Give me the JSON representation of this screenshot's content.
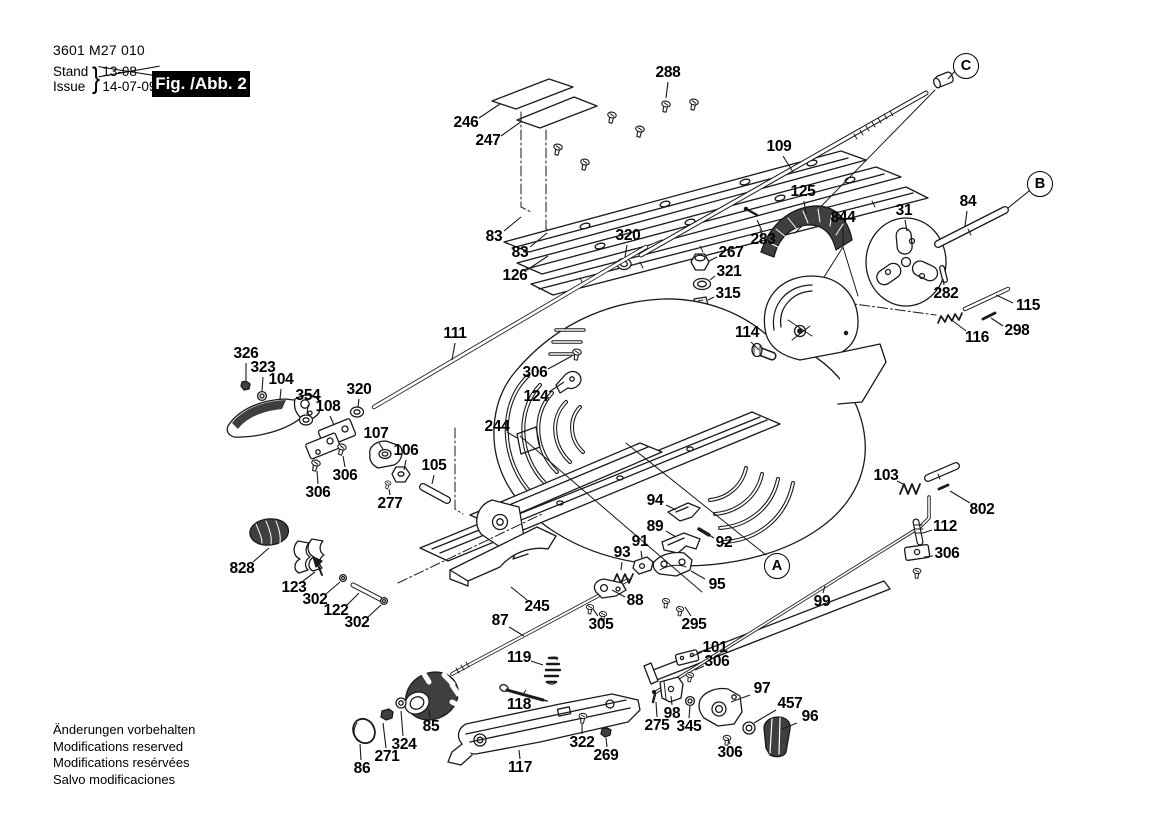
{
  "header": {
    "model_number": "3601 M27 010",
    "revision": {
      "stand_label": "Stand",
      "stand_value": "13-08",
      "issue_label": "Issue",
      "issue_value": "14-07-09",
      "brace": "}"
    },
    "figure_label": "Fig. /Abb. 2"
  },
  "footer": {
    "lines": [
      "Änderungen vorbehalten",
      "Modifications reserved",
      "Modifications resérvées",
      "Salvo modificaciones"
    ]
  },
  "colors": {
    "ink": "#1a1a1a",
    "paper": "#ffffff",
    "figure_box_bg": "#000000",
    "figure_box_text": "#ffffff",
    "dark_part": "#3f3f3f"
  },
  "diagram": {
    "reference_bubbles": [
      {
        "label": "A",
        "x": 777,
        "y": 566
      },
      {
        "label": "B",
        "x": 1040,
        "y": 184,
        "leader": [
          1029,
          191,
          1008,
          208
        ]
      },
      {
        "label": "C",
        "x": 966,
        "y": 66,
        "leader": [
          955,
          71,
          948,
          79
        ]
      }
    ],
    "callouts": [
      {
        "label": "288",
        "x": 668,
        "y": 73,
        "leader": [
          668,
          82,
          666,
          98
        ]
      },
      {
        "label": "246",
        "x": 466,
        "y": 123,
        "leader": [
          479,
          118,
          500,
          104
        ]
      },
      {
        "label": "247",
        "x": 488,
        "y": 141,
        "leader": [
          501,
          136,
          522,
          121
        ]
      },
      {
        "label": "83",
        "x": 494,
        "y": 237,
        "leader": [
          504,
          231,
          521,
          217
        ]
      },
      {
        "label": "83",
        "x": 520,
        "y": 253,
        "leader": [
          530,
          247,
          547,
          233
        ]
      },
      {
        "label": "126",
        "x": 515,
        "y": 276,
        "leader": [
          527,
          270,
          548,
          256
        ]
      },
      {
        "label": "320",
        "x": 628,
        "y": 236,
        "leader": [
          627,
          245,
          625,
          257
        ]
      },
      {
        "label": "109",
        "x": 779,
        "y": 147,
        "leader": [
          783,
          156,
          793,
          172
        ]
      },
      {
        "label": "125",
        "x": 803,
        "y": 192,
        "leader": [
          804,
          201,
          806,
          214
        ]
      },
      {
        "label": "844",
        "x": 843,
        "y": 218,
        "leader": [
          843,
          227,
          843,
          246
        ]
      },
      {
        "label": "283",
        "x": 763,
        "y": 240,
        "leader": [
          762,
          231,
          757,
          220
        ]
      },
      {
        "label": "31",
        "x": 904,
        "y": 211,
        "leader": [
          905,
          220,
          907,
          231
        ]
      },
      {
        "label": "84",
        "x": 968,
        "y": 202,
        "leader": [
          967,
          211,
          965,
          226
        ]
      },
      {
        "label": "282",
        "x": 946,
        "y": 294,
        "leader": [
          944,
          285,
          943,
          279
        ]
      },
      {
        "label": "115",
        "x": 1028,
        "y": 306,
        "leader": [
          1013,
          303,
          996,
          295
        ]
      },
      {
        "label": "298",
        "x": 1017,
        "y": 331,
        "leader": [
          1003,
          326,
          991,
          318
        ]
      },
      {
        "label": "116",
        "x": 977,
        "y": 338,
        "leader": [
          966,
          331,
          953,
          321
        ]
      },
      {
        "label": "267",
        "x": 731,
        "y": 253,
        "leader": [
          717,
          257,
          709,
          261
        ]
      },
      {
        "label": "321",
        "x": 729,
        "y": 272,
        "leader": [
          715,
          276,
          710,
          280
        ]
      },
      {
        "label": "315",
        "x": 728,
        "y": 294,
        "leader": [
          714,
          297,
          708,
          300
        ]
      },
      {
        "label": "114",
        "x": 747,
        "y": 333,
        "leader": [
          751,
          342,
          759,
          350
        ]
      },
      {
        "label": "306",
        "x": 535,
        "y": 373,
        "leader": [
          548,
          369,
          572,
          356
        ]
      },
      {
        "label": "124",
        "x": 536,
        "y": 397,
        "leader": [
          549,
          392,
          564,
          382
        ]
      },
      {
        "label": "111",
        "x": 455,
        "y": 334,
        "leader": [
          455,
          343,
          452,
          360
        ]
      },
      {
        "label": "326",
        "x": 246,
        "y": 354,
        "leader": [
          246,
          363,
          246,
          380
        ]
      },
      {
        "label": "323",
        "x": 263,
        "y": 368,
        "leader": [
          263,
          377,
          262,
          391
        ]
      },
      {
        "label": "104",
        "x": 281,
        "y": 380,
        "leader": [
          281,
          389,
          280,
          399
        ]
      },
      {
        "label": "354",
        "x": 308,
        "y": 396,
        "leader": [
          308,
          405,
          307,
          414
        ]
      },
      {
        "label": "108",
        "x": 328,
        "y": 407,
        "leader": [
          330,
          416,
          334,
          425
        ]
      },
      {
        "label": "320",
        "x": 359,
        "y": 390,
        "leader": [
          359,
          399,
          358,
          407
        ]
      },
      {
        "label": "107",
        "x": 376,
        "y": 434,
        "leader": [
          379,
          443,
          383,
          449
        ]
      },
      {
        "label": "106",
        "x": 406,
        "y": 451,
        "leader": [
          406,
          460,
          404,
          470
        ]
      },
      {
        "label": "105",
        "x": 434,
        "y": 466,
        "leader": [
          434,
          475,
          432,
          484
        ]
      },
      {
        "label": "306",
        "x": 345,
        "y": 476,
        "leader": [
          345,
          467,
          343,
          456
        ]
      },
      {
        "label": "306",
        "x": 318,
        "y": 493,
        "leader": [
          318,
          484,
          317,
          471
        ]
      },
      {
        "label": "277",
        "x": 390,
        "y": 504,
        "leader": [
          390,
          495,
          389,
          489
        ]
      },
      {
        "label": "244",
        "x": 497,
        "y": 427,
        "leader": [
          507,
          432,
          517,
          438
        ]
      },
      {
        "label": "828",
        "x": 242,
        "y": 569,
        "leader": [
          253,
          562,
          269,
          548
        ]
      },
      {
        "label": "123",
        "x": 294,
        "y": 588,
        "leader": [
          303,
          581,
          315,
          572
        ]
      },
      {
        "label": "302",
        "x": 315,
        "y": 600,
        "leader": [
          326,
          594,
          340,
          582
        ]
      },
      {
        "label": "122",
        "x": 336,
        "y": 611,
        "leader": [
          347,
          605,
          359,
          593
        ]
      },
      {
        "label": "302",
        "x": 357,
        "y": 623,
        "leader": [
          368,
          617,
          381,
          605
        ]
      },
      {
        "label": "245",
        "x": 537,
        "y": 607,
        "leader": [
          527,
          600,
          511,
          587
        ]
      },
      {
        "label": "87",
        "x": 500,
        "y": 621,
        "leader": [
          509,
          627,
          524,
          636
        ]
      },
      {
        "label": "305",
        "x": 601,
        "y": 625,
        "leader": [
          598,
          616,
          593,
          609
        ]
      },
      {
        "label": "88",
        "x": 635,
        "y": 601,
        "leader": [
          625,
          597,
          612,
          590
        ]
      },
      {
        "label": "93",
        "x": 622,
        "y": 553,
        "leader": [
          622,
          562,
          621,
          570
        ]
      },
      {
        "label": "91",
        "x": 640,
        "y": 542,
        "leader": [
          641,
          551,
          642,
          558
        ]
      },
      {
        "label": "89",
        "x": 655,
        "y": 527,
        "leader": [
          666,
          531,
          676,
          537
        ]
      },
      {
        "label": "94",
        "x": 655,
        "y": 501,
        "leader": [
          666,
          505,
          676,
          510
        ]
      },
      {
        "label": "92",
        "x": 724,
        "y": 543,
        "leader": [
          714,
          538,
          706,
          533
        ]
      },
      {
        "label": "95",
        "x": 717,
        "y": 585,
        "leader": [
          705,
          579,
          691,
          571
        ]
      },
      {
        "label": "295",
        "x": 694,
        "y": 625,
        "leader": [
          691,
          616,
          685,
          607
        ]
      },
      {
        "label": "99",
        "x": 822,
        "y": 602,
        "leader": [
          823,
          593,
          825,
          586
        ]
      },
      {
        "label": "103",
        "x": 886,
        "y": 476,
        "leader": [
          897,
          481,
          905,
          485
        ]
      },
      {
        "label": "802",
        "x": 982,
        "y": 510,
        "leader": [
          970,
          503,
          950,
          491
        ]
      },
      {
        "label": "112",
        "x": 945,
        "y": 527,
        "leader": [
          932,
          530,
          923,
          533
        ]
      },
      {
        "label": "306",
        "x": 947,
        "y": 554,
        "leader": [
          933,
          556,
          924,
          557
        ]
      },
      {
        "label": "101",
        "x": 715,
        "y": 648,
        "leader": [
          702,
          652,
          690,
          657
        ]
      },
      {
        "label": "306",
        "x": 717,
        "y": 662,
        "leader": [
          704,
          666,
          695,
          670
        ]
      },
      {
        "label": "97",
        "x": 762,
        "y": 689,
        "leader": [
          750,
          695,
          731,
          702
        ]
      },
      {
        "label": "457",
        "x": 790,
        "y": 704,
        "leader": [
          776,
          710,
          754,
          723
        ]
      },
      {
        "label": "96",
        "x": 810,
        "y": 717,
        "leader": [
          797,
          723,
          782,
          729
        ]
      },
      {
        "label": "98",
        "x": 672,
        "y": 714,
        "leader": [
          672,
          705,
          671,
          696
        ]
      },
      {
        "label": "275",
        "x": 657,
        "y": 726,
        "leader": [
          657,
          717,
          656,
          702
        ]
      },
      {
        "label": "345",
        "x": 689,
        "y": 727,
        "leader": [
          689,
          718,
          690,
          706
        ]
      },
      {
        "label": "306",
        "x": 730,
        "y": 753,
        "leader": [
          730,
          744,
          728,
          739
        ]
      },
      {
        "label": "119",
        "x": 519,
        "y": 658,
        "leader": [
          531,
          661,
          543,
          665
        ]
      },
      {
        "label": "118",
        "x": 519,
        "y": 705,
        "leader": [
          522,
          696,
          526,
          690
        ]
      },
      {
        "label": "85",
        "x": 431,
        "y": 727,
        "leader": [
          430,
          718,
          429,
          710
        ]
      },
      {
        "label": "324",
        "x": 404,
        "y": 745,
        "leader": [
          403,
          736,
          401,
          711
        ]
      },
      {
        "label": "271",
        "x": 387,
        "y": 757,
        "leader": [
          386,
          748,
          383,
          723
        ]
      },
      {
        "label": "86",
        "x": 362,
        "y": 769,
        "leader": [
          361,
          760,
          360,
          744
        ]
      },
      {
        "label": "117",
        "x": 520,
        "y": 768,
        "leader": [
          520,
          759,
          519,
          750
        ]
      },
      {
        "label": "322",
        "x": 582,
        "y": 743,
        "leader": [
          582,
          734,
          582,
          724
        ]
      },
      {
        "label": "269",
        "x": 606,
        "y": 756,
        "leader": [
          607,
          747,
          606,
          738
        ]
      }
    ]
  }
}
